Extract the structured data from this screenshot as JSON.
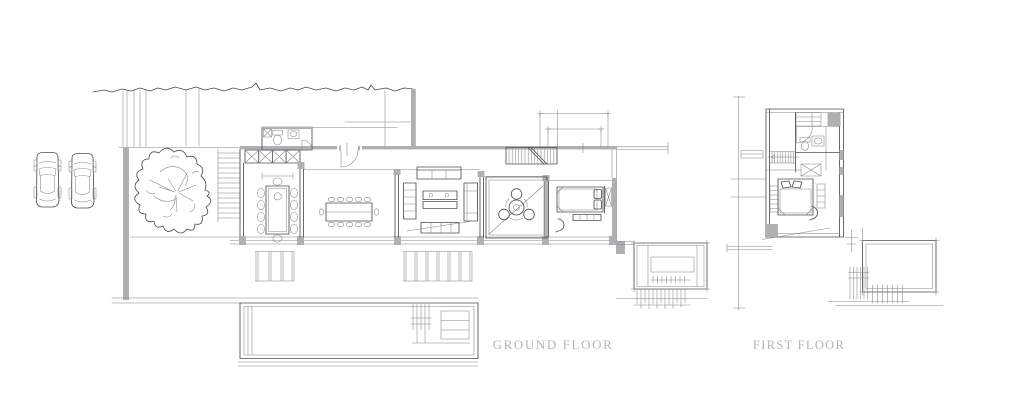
{
  "page": {
    "background": "#ffffff"
  },
  "palette": {
    "line": "#4e4e52",
    "line_light": "#85858a",
    "wall_fill": "#b0b0b3",
    "label_text": "#b8b5b0"
  },
  "plans": {
    "ground_floor": {
      "label": "GROUND FLOOR",
      "elements": [
        "site-boundary",
        "driveway",
        "car",
        "car",
        "tree",
        "entry-stairs",
        "closet-row",
        "bathroom",
        "entry-door",
        "dining-table",
        "kitchen-island",
        "living-room-furniture",
        "courtyard-table",
        "bedroom-bed",
        "staircase",
        "south-steps",
        "swimming-pool",
        "garden-terrace"
      ]
    },
    "first_floor": {
      "label": "FIRST FLOOR",
      "elements": [
        "staircase",
        "bathroom",
        "closet",
        "bedroom-bed",
        "terrace",
        "railing-hatch"
      ]
    }
  }
}
